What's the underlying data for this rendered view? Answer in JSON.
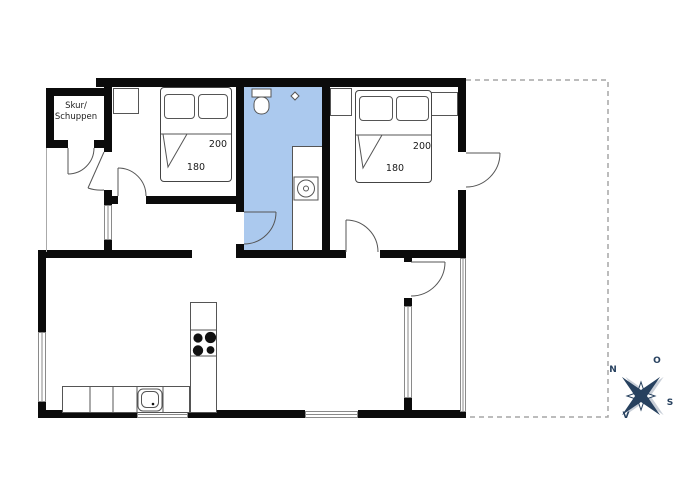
{
  "labels": {
    "shed": {
      "line1": "Skur/",
      "line2": "Schuppen"
    },
    "bedroom1_bed": {
      "length": "200",
      "width": "180"
    },
    "bedroom2_bed": {
      "length": "200",
      "width": "180"
    },
    "compass": {
      "n": "N",
      "o": "O",
      "s": "S",
      "v": "V"
    }
  },
  "colors": {
    "wall": "#0b0b0b",
    "bathroom": "#abc9ee",
    "compass": "#27415f",
    "line": "#555555",
    "window": "#8a8a8a",
    "dash": "#a5a5a5"
  }
}
